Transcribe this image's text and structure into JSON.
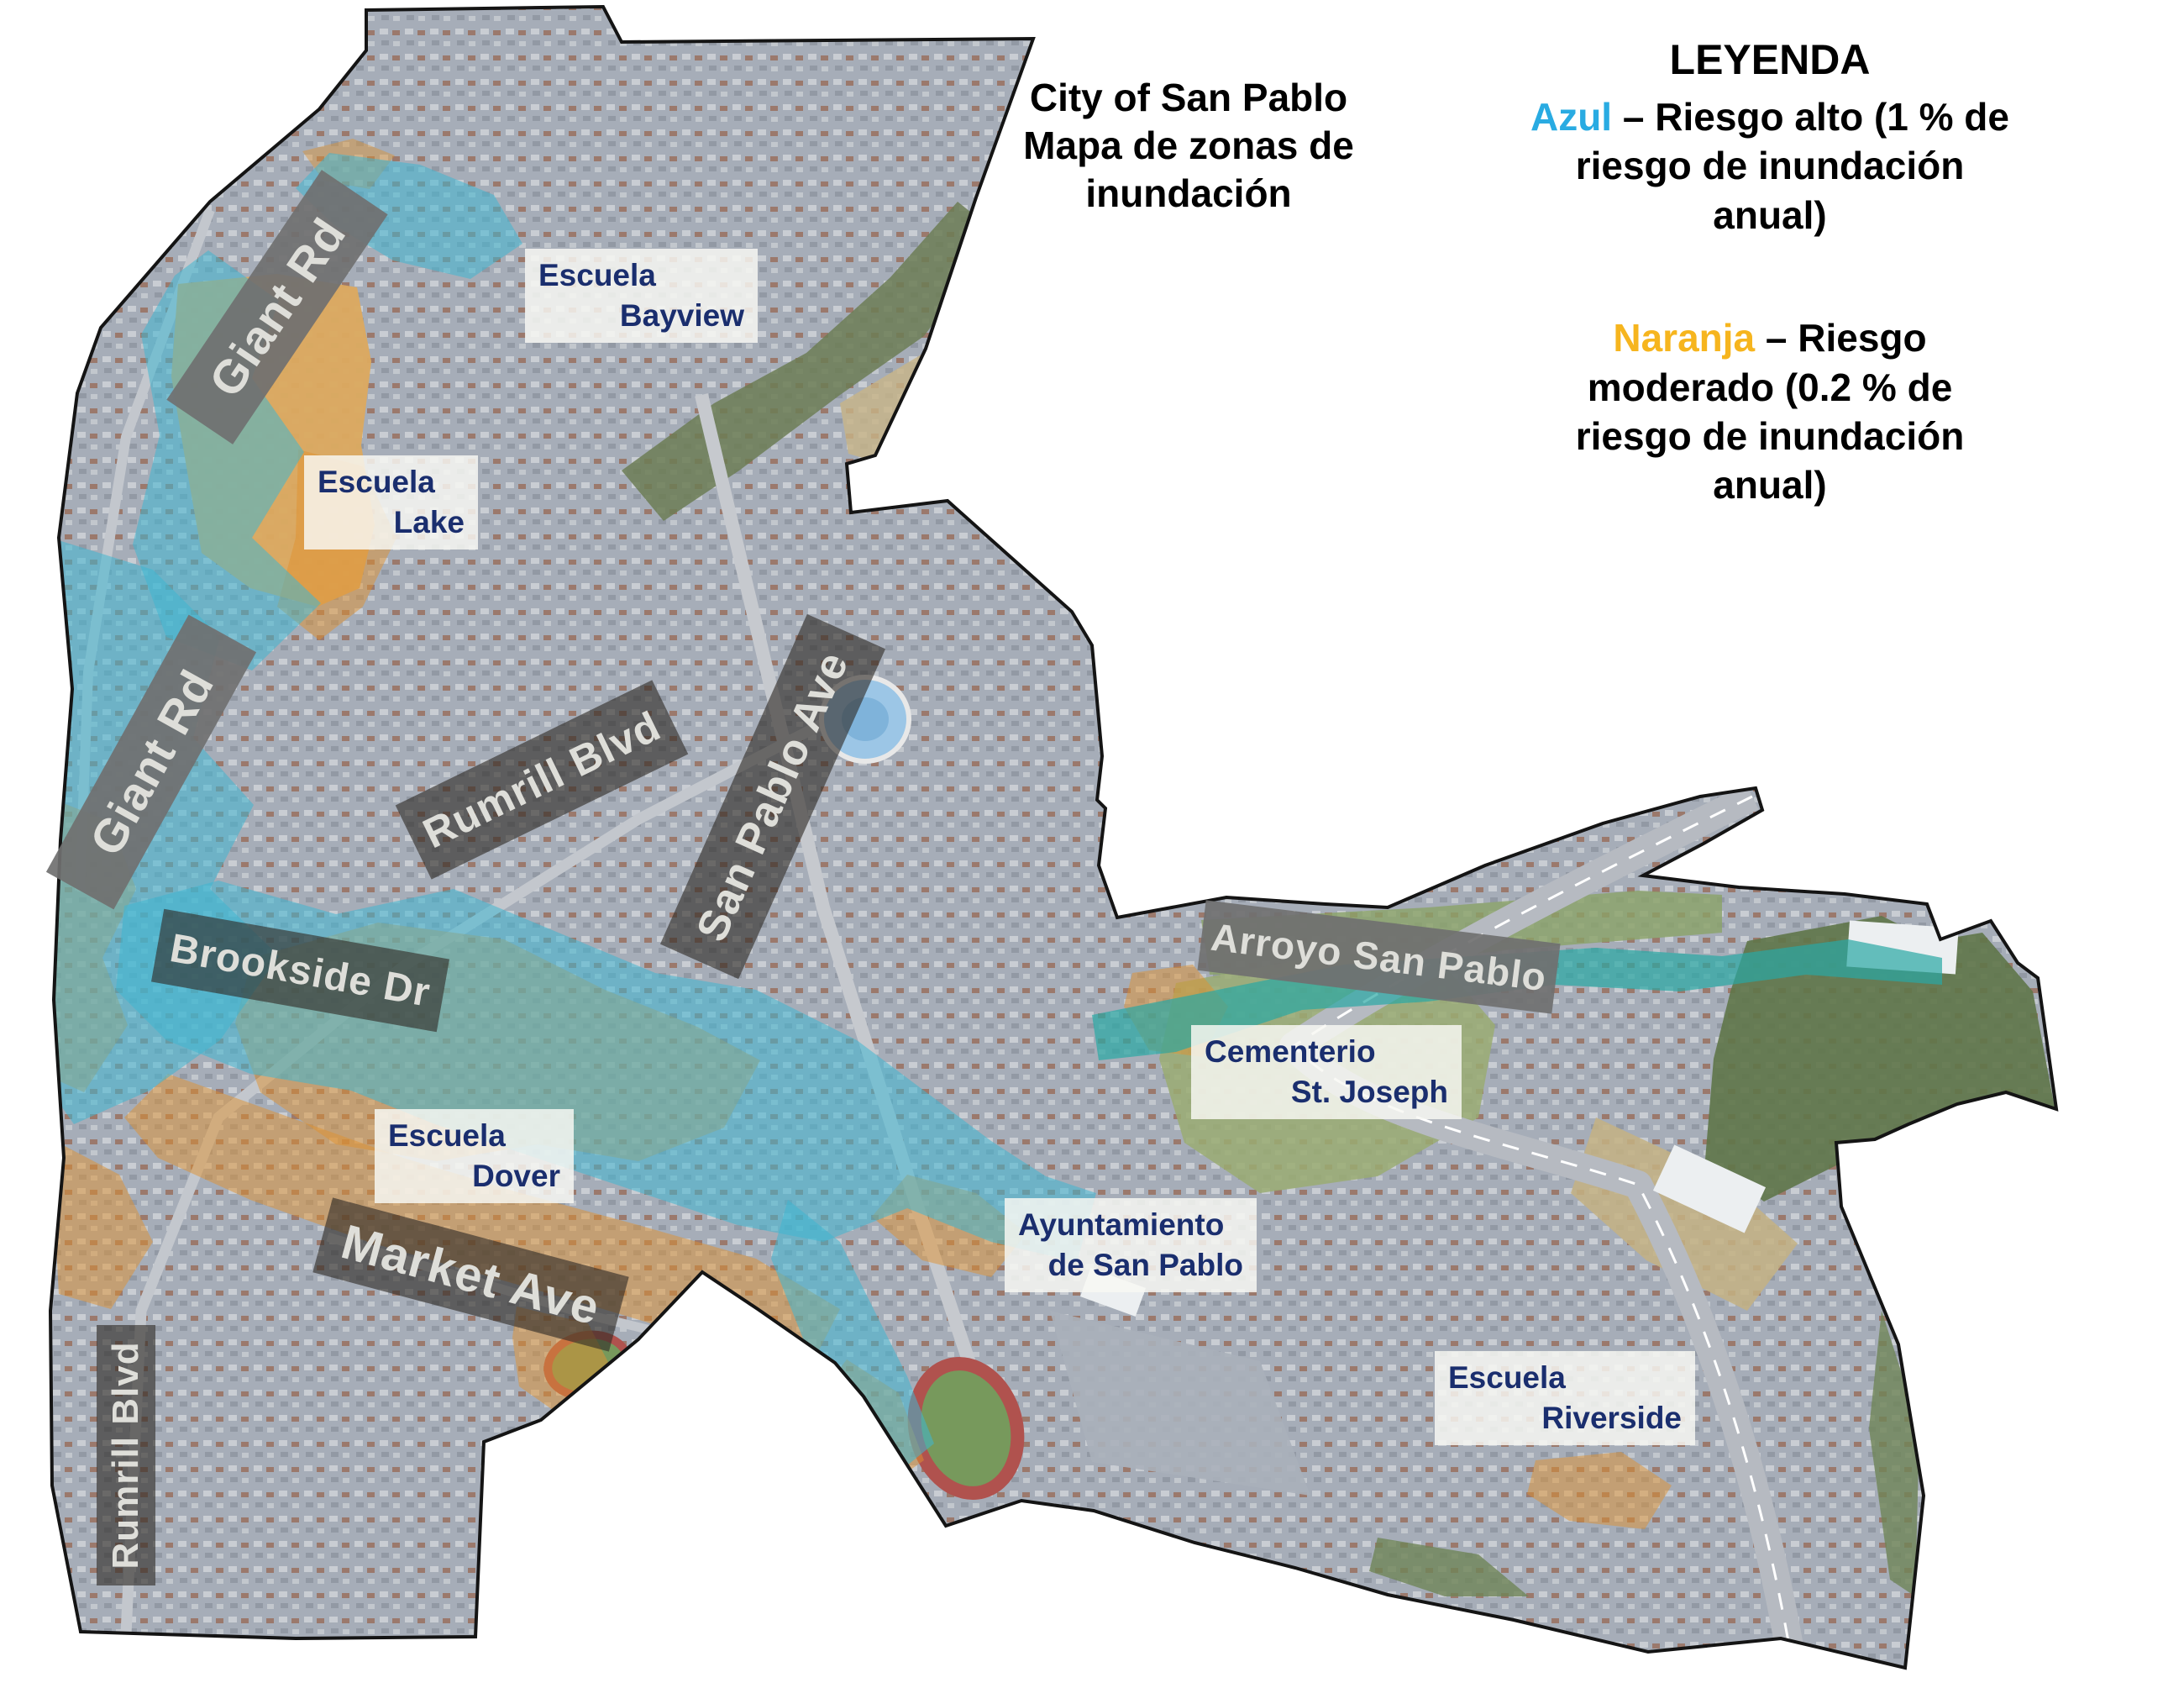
{
  "map_title": {
    "line1": "City of San Pablo",
    "line2": "Mapa de zonas de",
    "line3": "inundación"
  },
  "legend": {
    "heading": "LEYENDA",
    "high_risk": {
      "color_word": "Azul",
      "color_hex": "#29abe2",
      "rest": "– Riesgo alto (1 % de riesgo de inundación anual)"
    },
    "moderate_risk": {
      "color_word": "Naranja",
      "color_hex": "#f6b51e",
      "rest": "– Riesgo moderado (0.2 % de riesgo de inundación anual)"
    }
  },
  "street_labels": [
    {
      "id": "giant-rd-north",
      "label": "Giant Rd"
    },
    {
      "id": "giant-rd-south",
      "label": "Giant Rd"
    },
    {
      "id": "rumrill-blvd-mid",
      "label": "Rumrill Blvd"
    },
    {
      "id": "san-pablo-ave",
      "label": "San Pablo Ave"
    },
    {
      "id": "brookside-dr",
      "label": "Brookside Dr"
    },
    {
      "id": "market-ave",
      "label": "Market Ave"
    },
    {
      "id": "arroyo-san-pablo",
      "label": "Arroyo San Pablo"
    },
    {
      "id": "rumrill-blvd-south",
      "label": "Rumrill Blvd"
    }
  ],
  "place_labels": [
    {
      "id": "escuela-bayview",
      "line1": "Escuela",
      "line2": "Bayview"
    },
    {
      "id": "escuela-lake",
      "line1": "Escuela",
      "line2": "Lake"
    },
    {
      "id": "escuela-dover",
      "line1": "Escuela",
      "line2": "Dover"
    },
    {
      "id": "cementerio-st-joseph",
      "line1": "Cementerio",
      "line2": "St. Joseph"
    },
    {
      "id": "ayuntamiento-de-san-pablo",
      "line1": "Ayuntamiento",
      "line2": "de San Pablo"
    },
    {
      "id": "escuela-riverside",
      "line1": "Escuela",
      "line2": "Riverside"
    }
  ],
  "flood_zone_colors": {
    "high_risk_blue": "#3fb7d2",
    "moderate_risk_orange": "#e0922f"
  }
}
